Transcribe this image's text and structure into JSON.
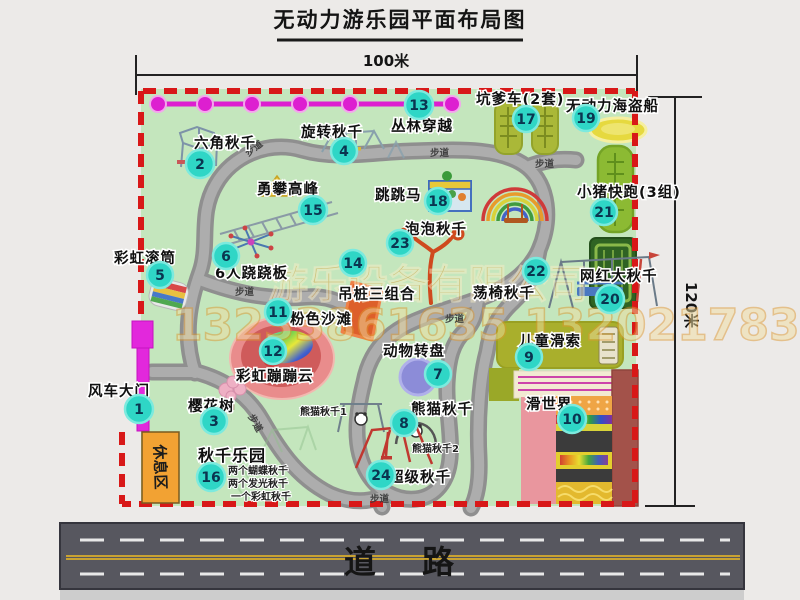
{
  "title": "无动力游乐园平面布局图",
  "dimensions": {
    "width": "100米",
    "height": "120米"
  },
  "road": {
    "label": "道路"
  },
  "walkway": {
    "label": "步道"
  },
  "rest_area": {
    "label": "休息区"
  },
  "watermark": {
    "company": "游乐设备有限公司",
    "phone": "13233861635 13202178333"
  },
  "attractions": [
    {
      "num": "1",
      "name": "风车大门"
    },
    {
      "num": "2",
      "name": "六角秋千"
    },
    {
      "num": "3",
      "name": "樱花树"
    },
    {
      "num": "4",
      "name": "旋转秋千"
    },
    {
      "num": "5",
      "name": "彩虹滚筒"
    },
    {
      "num": "6",
      "name": "6人跷跷板"
    },
    {
      "num": "7",
      "name": "动物转盘"
    },
    {
      "num": "8",
      "name": "熊猫秋千"
    },
    {
      "num": "9",
      "name": "儿童滑索"
    },
    {
      "num": "10",
      "name": "滑世界"
    },
    {
      "num": "11",
      "name": "粉色沙滩"
    },
    {
      "num": "12",
      "name": "彩虹蹦蹦云"
    },
    {
      "num": "13",
      "name": "丛林穿越"
    },
    {
      "num": "14",
      "name": "吊桩三组合"
    },
    {
      "num": "15",
      "name": "勇攀高峰"
    },
    {
      "num": "16",
      "name": "秋千乐园"
    },
    {
      "num": "17",
      "name": "坑爹车(2套)"
    },
    {
      "num": "18",
      "name": "跳跳马"
    },
    {
      "num": "19",
      "name": "无动力海盗船"
    },
    {
      "num": "20",
      "name": "网红大秋千"
    },
    {
      "num": "21",
      "name": "小猪快跑(3组)"
    },
    {
      "num": "22",
      "name": "荡椅秋千"
    },
    {
      "num": "23",
      "name": "泡泡秋千"
    },
    {
      "num": "24",
      "name": "超级秋千"
    }
  ],
  "notes": {
    "swing_park": [
      "两个蝴蝶秋千",
      "两个发光秋千",
      "一个彩虹秋千"
    ],
    "panda_swing_1": "熊猫秋千1",
    "panda_swing_2": "熊猫秋千2"
  },
  "colors": {
    "background": "#eceae8",
    "park_fill": "#c4e6bd",
    "boundary_red": "#d81818",
    "path_gray": "#9b9b9b",
    "badge_teal": "#2fd6c6",
    "gate_magenta": "#e228dc",
    "zipline_magenta": "#dd1fd0",
    "rest_area_orange": "#f2a233",
    "road_gray": "#57575f",
    "watermark_orange": "#d89a30"
  }
}
